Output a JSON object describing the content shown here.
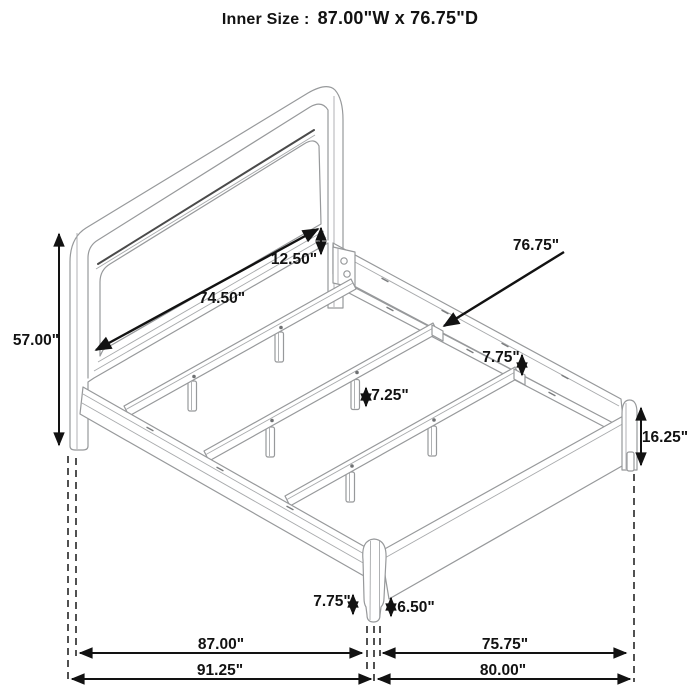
{
  "title": {
    "label": "Inner Size :",
    "value": "87.00\"W x 76.75\"D"
  },
  "diagram": {
    "subject": "bed-frame-isometric-dimension-drawing",
    "labels": {
      "headboard_panel_gap": "12.50\"",
      "headboard_inner_width": "74.50\"",
      "slat_inner_depth": "76.75\"",
      "headboard_height": "57.00\"",
      "cleat_junction_height": "7.75\"",
      "slat_support_leg_height": "7.25\"",
      "footboard_height": "16.25\"",
      "front_leg_total_height": "7.75\"",
      "front_leg_exposed_height": "6.50\"",
      "inner_width": "87.00\"",
      "inner_depth": "75.75\"",
      "overall_width": "91.25\"",
      "overall_depth": "80.00\""
    }
  }
}
